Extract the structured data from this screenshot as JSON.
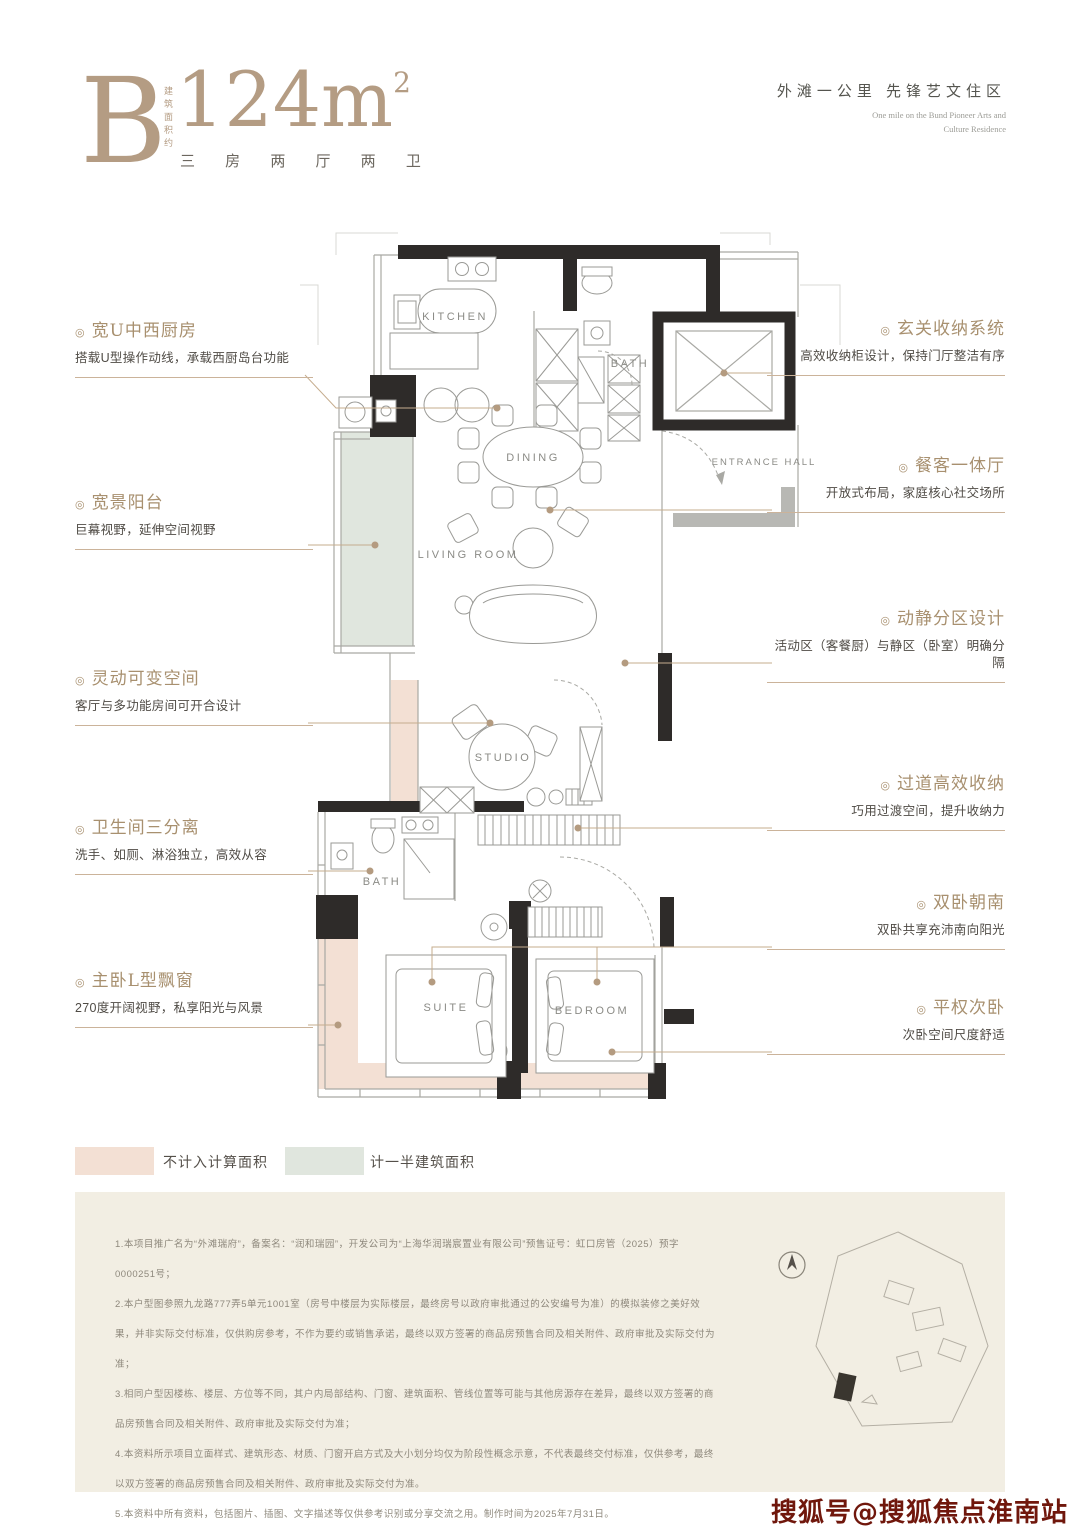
{
  "header": {
    "unit": "B",
    "area_vertical_label": "建筑面积约",
    "area": "124m",
    "area_sup": "2",
    "layout": "三 房 两 厅 两 卫",
    "slogan_cn": "外滩一公里  先锋艺文住区",
    "slogan_en_line1": "One mile on the Bund Pioneer Arts and",
    "slogan_en_line2": "Culture Residence"
  },
  "ui": {
    "annotation_marker": "◎"
  },
  "floorplan": {
    "rooms": [
      {
        "id": "kitchen",
        "label": "KITCHEN"
      },
      {
        "id": "bath-upper",
        "label": "BATH"
      },
      {
        "id": "dining",
        "label": "DINING"
      },
      {
        "id": "entrance-hall",
        "label": "ENTRANCE HALL"
      },
      {
        "id": "living-room",
        "label": "LIVING ROOM"
      },
      {
        "id": "studio",
        "label": "STUDIO"
      },
      {
        "id": "bath-lower",
        "label": "BATH"
      },
      {
        "id": "suite",
        "label": "SUITE"
      },
      {
        "id": "bedroom",
        "label": "BEDROOM"
      }
    ]
  },
  "annotations_left": [
    {
      "title": "宽U中西厨房",
      "desc": "搭载U型操作动线，承载西厨岛台功能"
    },
    {
      "title": "宽景阳台",
      "desc": "巨幕视野，延伸空间视野"
    },
    {
      "title": "灵动可变空间",
      "desc": "客厅与多功能房间可开合设计"
    },
    {
      "title": "卫生间三分离",
      "desc": "洗手、如厕、淋浴独立，高效从容"
    },
    {
      "title": "主卧L型飘窗",
      "desc": "270度开阔视野，私享阳光与风景"
    }
  ],
  "annotations_right": [
    {
      "title": "玄关收纳系统",
      "desc": "高效收纳柜设计，保持门厅整洁有序"
    },
    {
      "title": "餐客一体厅",
      "desc": "开放式布局，家庭核心社交场所"
    },
    {
      "title": "动静分区设计",
      "desc": "活动区（客餐厨）与静区（卧室）明确分隔"
    },
    {
      "title": "过道高效收纳",
      "desc": "巧用过渡空间，提升收纳力"
    },
    {
      "title": "双卧朝南",
      "desc": "双卧共享充沛南向阳光"
    },
    {
      "title": "平权次卧",
      "desc": "次卧空间尺度舒适"
    }
  ],
  "legend": {
    "items": [
      {
        "label": "不计入计算面积",
        "color": "#f3e0d4"
      },
      {
        "label": "计一半建筑面积",
        "color": "#e0e6de"
      }
    ]
  },
  "disclaimer": {
    "lines": [
      "1.本项目推广名为“外滩瑞府”，备案名：“润和瑞园”，开发公司为“上海华润瑞宸置业有限公司”预售证号：虹口房管（2025）预字0000251号；",
      "2.本户型图参照九龙路777弄5单元1001室（房号中楼层为实际楼层，最终房号以政府审批通过的公安编号为准）的模拟装修之美好效果，并非实际交付标准，仅供购房参考，不作为要约或销售承诺，最终以双方签署的商品房预售合同及相关附件、政府审批及实际交付为准；",
      "3.相同户型因楼栋、楼层、方位等不同，其户内局部结构、门窗、建筑面积、管线位置等可能与其他房源存在差异，最终以双方签署的商品房预售合同及相关附件、政府审批及实际交付为准；",
      "4.本资料所示项目立面样式、建筑形态、材质、门窗开启方式及大小划分均仅为阶段性概念示意，不代表最终交付标准，仅供参考，最终以双方签署的商品房预售合同及相关附件、政府审批及实际交付为准。",
      "5.本资料中所有资料，包括图片、插图、文字描述等仅供参考识别或分享交流之用。制作时间为2025年7月31日。"
    ]
  },
  "watermark": "搜狐号@搜狐焦点淮南站",
  "colors": {
    "accent_tan": "#a8906f",
    "wall_black": "#2e2b29",
    "pink_zone": "#f3e0d4",
    "green_zone": "#e0e6de",
    "leader_tan": "#c5ac8e",
    "watermark_red": "#70170c",
    "disclaimer_bg": "#f2eee3"
  }
}
